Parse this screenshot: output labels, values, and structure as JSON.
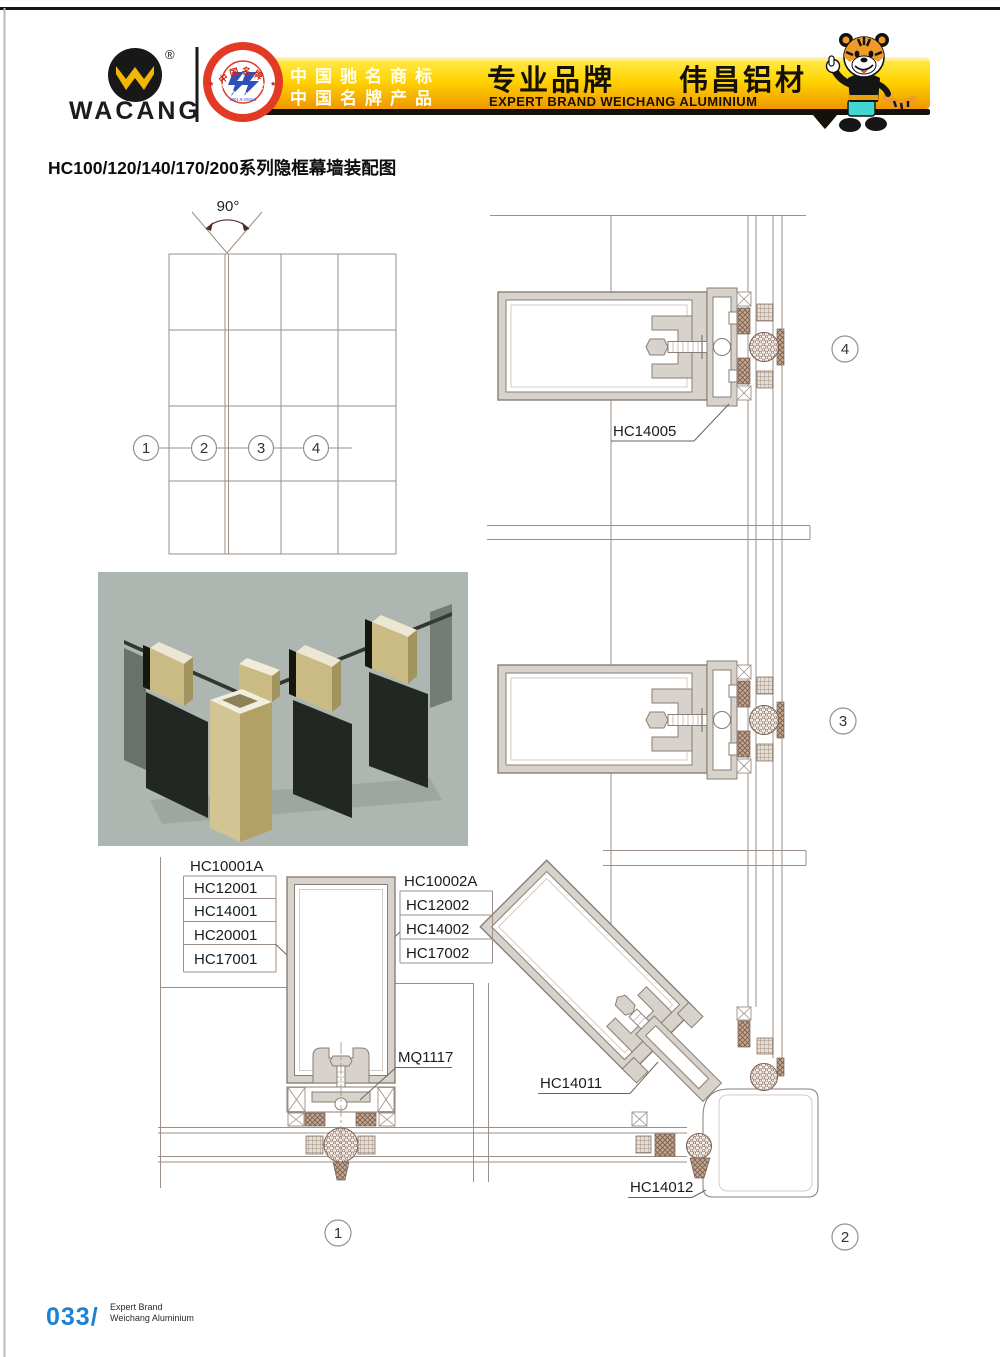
{
  "header": {
    "brand": "WACANG",
    "registered_mark": "®",
    "badge": {
      "arc_top": "中国名牌",
      "arc_bottom": "CHINA TOP BRAND",
      "year": "2001.9-2004.9",
      "star_left": "★",
      "star_right": "★"
    },
    "banner": {
      "line1": "中国驰名商标",
      "line2": "中国名牌产品",
      "main_cn": "专业品牌　　伟昌铝材",
      "sub_en": "EXPERT BRAND WEICHANG ALUMINIUM"
    }
  },
  "page_title": "HC100/120/140/170/200系列隐框幕墙装配图",
  "elevation": {
    "angle": "90°",
    "callouts": [
      "1",
      "2",
      "3",
      "4"
    ]
  },
  "details": {
    "d1": {
      "num": "1",
      "left": [
        "HC10001A",
        "HC12001",
        "HC14001",
        "HC20001",
        "HC17001"
      ],
      "right": [
        "HC10002A",
        "HC12002",
        "HC14002",
        "HC17002"
      ],
      "mq": "MQ1117"
    },
    "d2": {
      "num": "2",
      "a": "HC14011",
      "b": "HC14012"
    },
    "d3": {
      "num": "3"
    },
    "d4": {
      "num": "4",
      "part": "HC14005"
    }
  },
  "footer": {
    "page_number": "033/",
    "tagline_line1": "Expert Brand",
    "tagline_line2": "Weichang Aluminium"
  },
  "colors": {
    "banner_yellow": "#ffd400",
    "banner_orange": "#ef9700",
    "badge_red": "#e23a24",
    "badge_blue": "#2d50bd",
    "logo_yellow": "#f2b705",
    "footer_blue": "#1b82d6",
    "drawing_line": "#9b8f87",
    "profile_fill": "#d7d2cb",
    "render_background": "#aeb6b2"
  }
}
